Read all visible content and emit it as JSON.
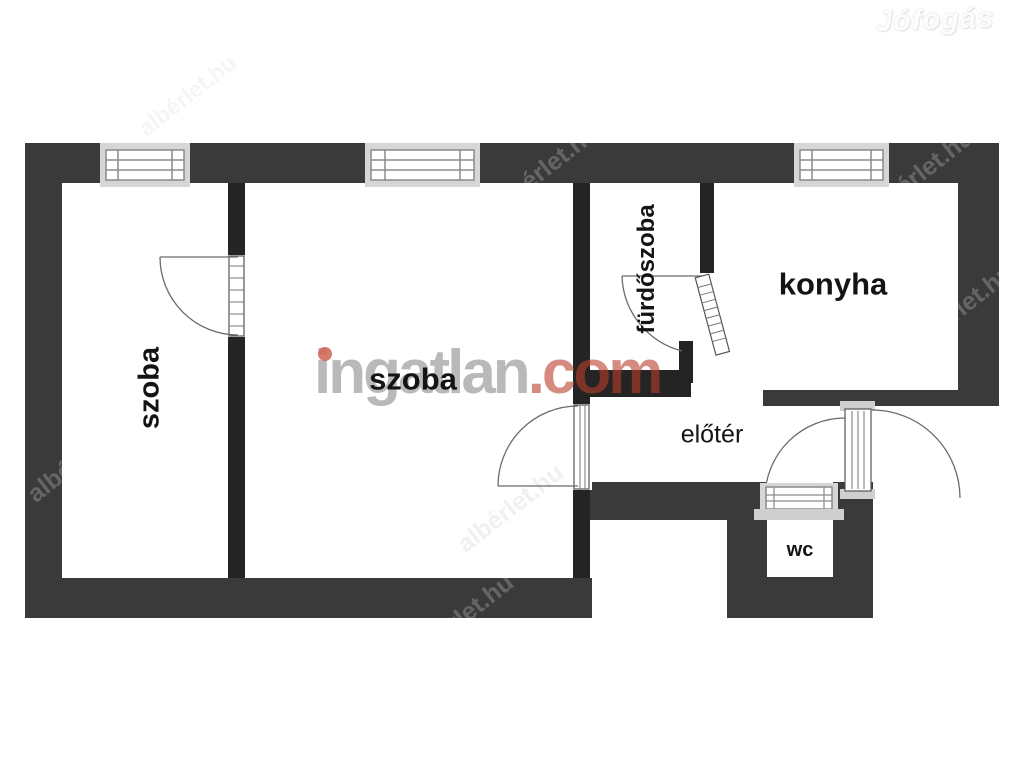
{
  "rooms": [
    {
      "id": "szoba-left",
      "label": "szoba"
    },
    {
      "id": "szoba-middle",
      "label": "szoba"
    },
    {
      "id": "furdoszoba",
      "label": "fürdőszoba"
    },
    {
      "id": "konyha",
      "label": "konyha"
    },
    {
      "id": "eloter",
      "label": "előtér"
    },
    {
      "id": "wc",
      "label": "wc"
    }
  ],
  "watermarks": {
    "brand_gray": "ingatlan",
    "brand_red": ".com",
    "corner_logo": "Jófogás",
    "diagonal": "albérlet.hu",
    "house_icon": "⌂"
  },
  "colors": {
    "outer_wall": "#3a3a3a",
    "interior_wall": "#242424",
    "window_frame": "#d6d6d6",
    "brand_gray": "#9b9b9b",
    "brand_red": "#bb3e2d",
    "door_arc": "#6a6a6a"
  }
}
